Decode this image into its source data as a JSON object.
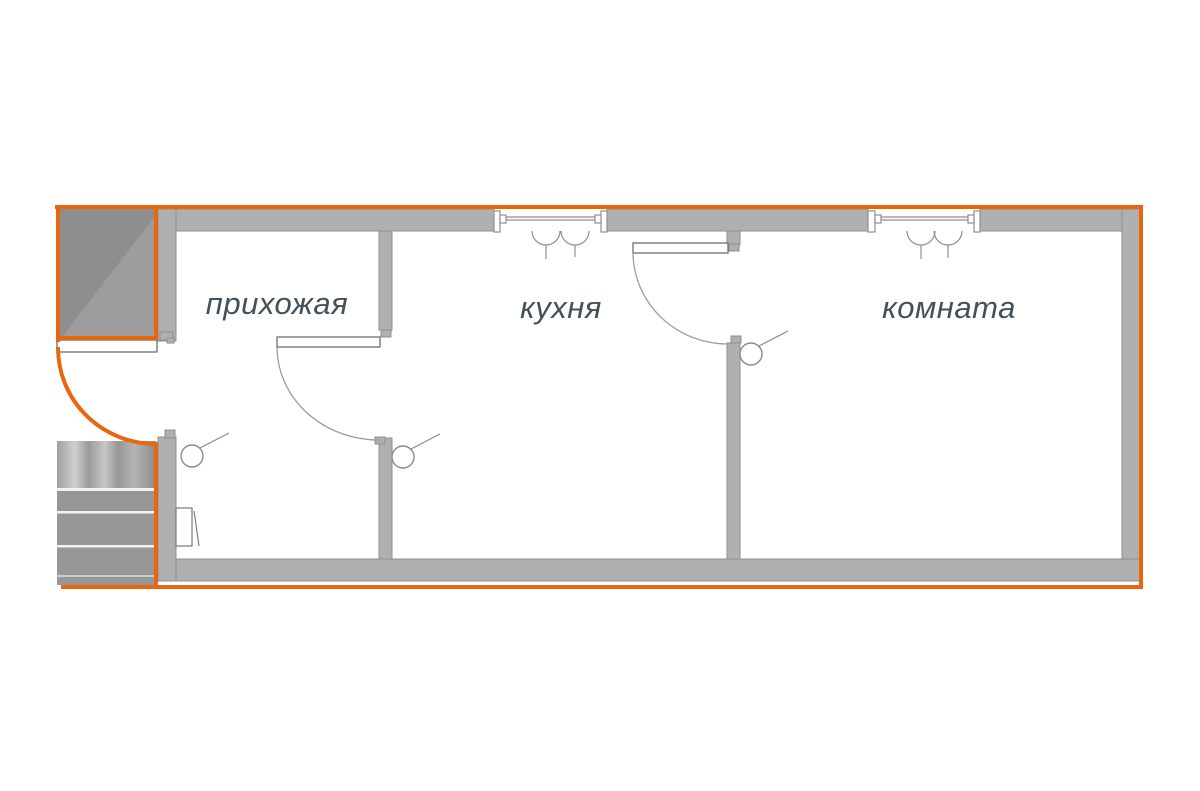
{
  "diagram": {
    "type": "floor-plan",
    "rooms": [
      {
        "id": "hallway",
        "label": "прихожая"
      },
      {
        "id": "kitchen",
        "label": "кухня"
      },
      {
        "id": "room",
        "label": "комната"
      }
    ],
    "icons": {
      "vent": "window-vent-icon",
      "switch": "wall-switch-icon",
      "panel": "electrical-panel-icon",
      "door_arc": "door-swing-arc",
      "stairs": "staircase",
      "landing": "landing-shaded-area"
    },
    "colors": {
      "outline": "#e8670e",
      "wall": "#b0b0b0",
      "wall_edge": "#8f8f8f",
      "label": "#42505a",
      "outside_dark": "#8e8e8e",
      "outside_light": "#9d9d9d",
      "stairs": "#979797",
      "stair_stripe": "#f2f2f2"
    }
  }
}
